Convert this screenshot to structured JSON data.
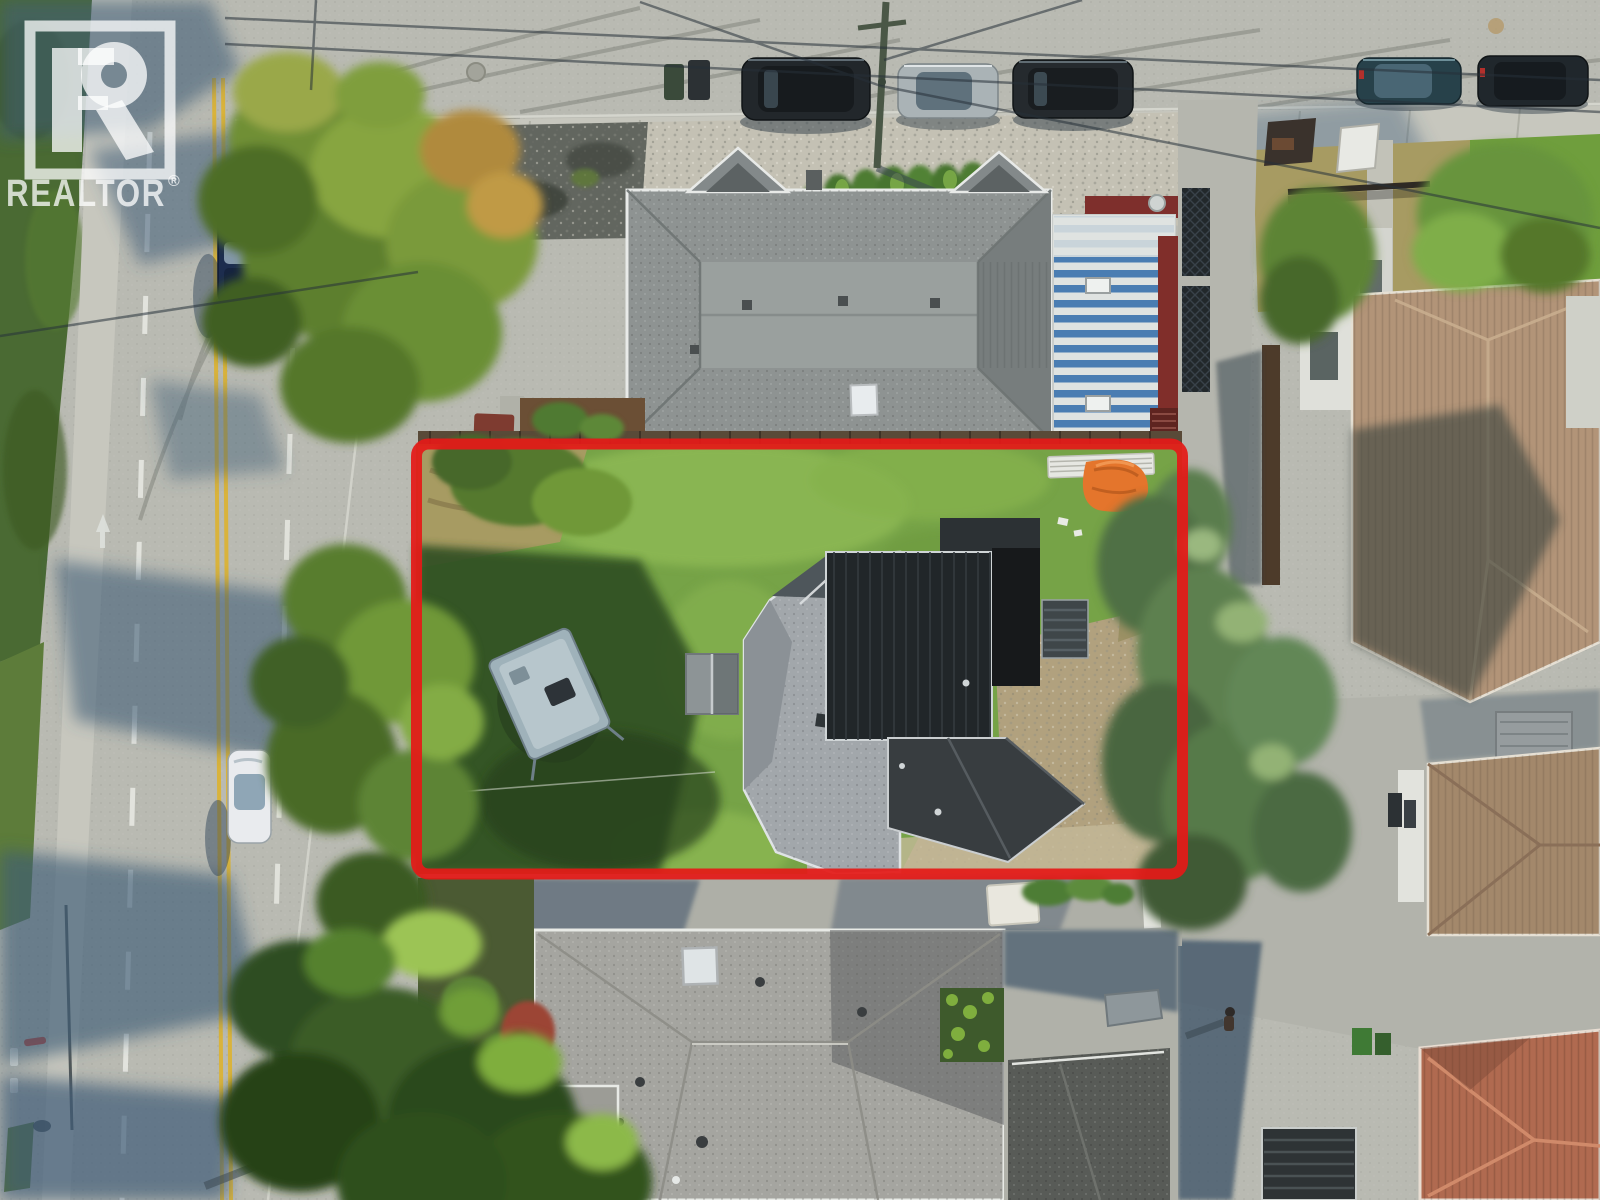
{
  "image": {
    "type": "aerial-drone-photo",
    "subject": "residential corner lot outlined in red for a real-estate listing"
  },
  "watermark": {
    "name": "REALTOR",
    "registered": "®"
  },
  "colors": {
    "lot_outline": "#e41a18",
    "watermark_fill": "rgba(255,255,255,0.75)",
    "road": "#b9bab2",
    "road_shadow": "#3f5d77",
    "sidewalk": "#c7c7be",
    "lane_yellow": "#d9b33c",
    "lane_white": "#e7e8e2",
    "grass": "#76a347",
    "grass_shade": "#2f4d24",
    "grass_dry": "#a79b62",
    "dirt": "#b1a17e",
    "hedge": "#4a6a33",
    "roof_top_building": "#8e9392",
    "metal_roof_blue": "#4a7db2",
    "metal_roof_white": "#dfe3e1",
    "metal_roof_red_trim": "#7e2f2c",
    "roof_house_gray": "#a2a7ab",
    "roof_house_dark": "#212629",
    "roof_bottom_house": "#a5a5a0",
    "roof_tan": "#b29478",
    "roof_brown": "#a3886b",
    "roof_red_tile": "#b06a50",
    "tarp_orange": "#e4752c",
    "trailer_gray": "#9fb2ba",
    "tree_green": "#6f9838",
    "conifer_green": "#49663c",
    "car_dark": "#22272b",
    "car_silver": "#aab3b6",
    "car_blue": "#1d2d4e",
    "car_white": "#e9ebee",
    "car_teal": "#27414a"
  },
  "objects": [
    "lot-outline",
    "subject-house",
    "travel-trailer",
    "garden-shed",
    "orange-tarp",
    "lumber-stack",
    "left-street",
    "top-street",
    "parked-cars",
    "utility-pole",
    "power-lines",
    "apartment-building",
    "blue-metal-roof-building",
    "neighbor-house-south",
    "neighbor-house-east",
    "red-tile-roof",
    "conifer-trees",
    "deciduous-trees",
    "pedestrian",
    "realtor-watermark"
  ]
}
